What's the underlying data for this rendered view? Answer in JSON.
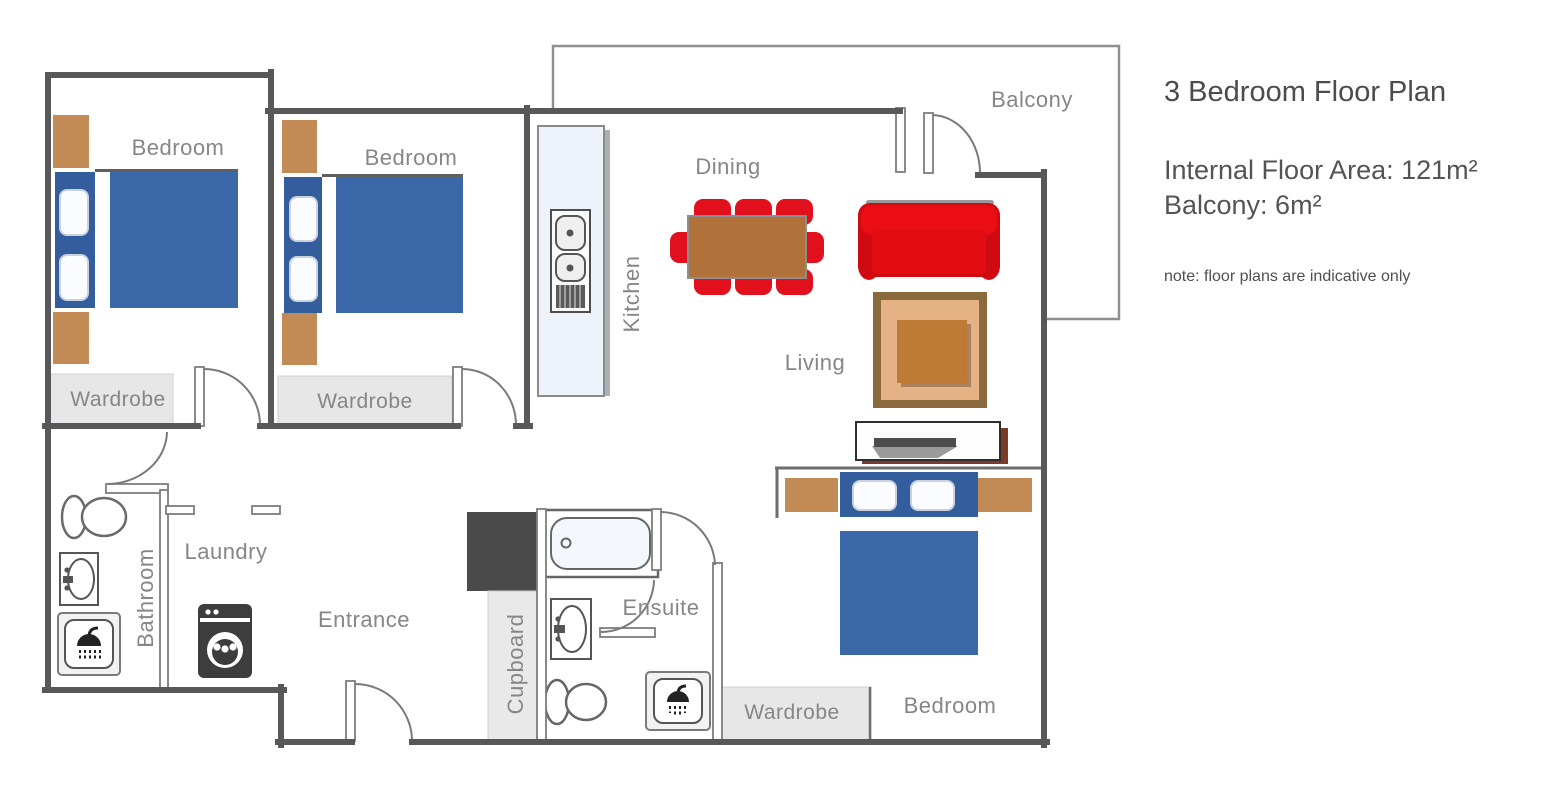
{
  "panel": {
    "title": "3 Bedroom Floor Plan",
    "internal_area": "Internal Floor Area: 121m²",
    "balcony_area": "Balcony: 6m²",
    "note": "note: floor plans are indicative only"
  },
  "rooms": {
    "bedroom1": "Bedroom",
    "bedroom2": "Bedroom",
    "bedroom3": "Bedroom",
    "wardrobe1": "Wardrobe",
    "wardrobe2": "Wardrobe",
    "wardrobe3": "Wardrobe",
    "kitchen": "Kitchen",
    "dining": "Dining",
    "living": "Living",
    "balcony": "Balcony",
    "bathroom": "Bathroom",
    "laundry": "Laundry",
    "entrance": "Entrance",
    "cupboard": "Cupboard",
    "ensuite": "Ensuite"
  },
  "colors": {
    "wall": "#58585a",
    "thin_line": "#8f8f8f",
    "label_gray": "#868686",
    "bed_blue": "#3a68a8",
    "headboard_blue": "#335d9c",
    "wood_brown": "#c28a54",
    "chair_red": "#e2101c",
    "sofa_red": "#e20d13",
    "dining_table_brown": "#b0713a",
    "rug_border_brown": "#8a6a3c",
    "rug_field_tan": "#e5b285",
    "rug_table_brown": "#bf7a35",
    "wardrobe_gray": "#e7e7e7",
    "kitchen_counter": "#edf2fb",
    "dark_block": "#4a4a4a",
    "tv_shadow_brown": "#7c3a28"
  }
}
